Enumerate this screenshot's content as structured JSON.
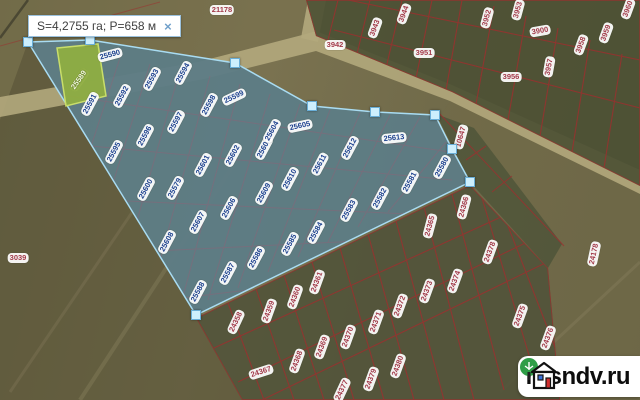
{
  "tooltip": {
    "area_perimeter": "S=4,2755 га; P=658 м",
    "close_label": "×"
  },
  "watermark": {
    "brand": "rosndv.ru"
  },
  "colors": {
    "selection_fill": "rgba(118,168,215,0.44)",
    "selection_stroke": "#a9dcf2",
    "handle_fill": "#cdeffd",
    "handle_border": "#69aed7",
    "parcel_line_red": "#9e2f2f",
    "label_text_blue": "#1d418f",
    "label_text_red": "#a33a4a",
    "highlight_parcel_green": "#93b23c",
    "road_tan": "#b3a87c",
    "field_olive": "#6e6847"
  },
  "selection": {
    "handles": [
      [
        28,
        42
      ],
      [
        90,
        40
      ],
      [
        235,
        63
      ],
      [
        312,
        106
      ],
      [
        375,
        112
      ],
      [
        435,
        115
      ],
      [
        452,
        149
      ],
      [
        470,
        182
      ],
      [
        196,
        315
      ]
    ]
  },
  "parcels": {
    "highlight": {
      "t": "25589",
      "x": 79,
      "y": 80,
      "r": -55
    },
    "selected": [
      {
        "t": "25590",
        "x": 110,
        "y": 55,
        "r": -15
      },
      {
        "t": "25591",
        "x": 90,
        "y": 104,
        "r": -62
      },
      {
        "t": "25592",
        "x": 122,
        "y": 96,
        "r": -62
      },
      {
        "t": "25593",
        "x": 152,
        "y": 79,
        "r": -62
      },
      {
        "t": "25594",
        "x": 183,
        "y": 73,
        "r": -62
      },
      {
        "t": "25595",
        "x": 114,
        "y": 152,
        "r": -62
      },
      {
        "t": "25596",
        "x": 145,
        "y": 136,
        "r": -62
      },
      {
        "t": "25597",
        "x": 176,
        "y": 122,
        "r": -62
      },
      {
        "t": "25598",
        "x": 209,
        "y": 105,
        "r": -62
      },
      {
        "t": "25599",
        "x": 234,
        "y": 97,
        "r": -25
      },
      {
        "t": "25600",
        "x": 146,
        "y": 189,
        "r": -62
      },
      {
        "t": "25601",
        "x": 203,
        "y": 165,
        "r": -62
      },
      {
        "t": "25602",
        "x": 233,
        "y": 155,
        "r": -62
      },
      {
        "t": "25603",
        "x": 264,
        "y": 148,
        "r": -62
      },
      {
        "t": "25604",
        "x": 272,
        "y": 131,
        "r": -62
      },
      {
        "t": "25605",
        "x": 300,
        "y": 126,
        "r": -12
      },
      {
        "t": "25606",
        "x": 229,
        "y": 208,
        "r": -62
      },
      {
        "t": "25607",
        "x": 198,
        "y": 222,
        "r": -62
      },
      {
        "t": "25608",
        "x": 167,
        "y": 242,
        "r": -62
      },
      {
        "t": "25609",
        "x": 264,
        "y": 193,
        "r": -62
      },
      {
        "t": "25610",
        "x": 290,
        "y": 179,
        "r": -62
      },
      {
        "t": "25611",
        "x": 320,
        "y": 164,
        "r": -62
      },
      {
        "t": "25612",
        "x": 350,
        "y": 148,
        "r": -62
      },
      {
        "t": "25613",
        "x": 394,
        "y": 138,
        "r": -6
      },
      {
        "t": "25579",
        "x": 175,
        "y": 188,
        "r": -62
      },
      {
        "t": "25580",
        "x": 442,
        "y": 167,
        "r": -62
      },
      {
        "t": "25581",
        "x": 410,
        "y": 182,
        "r": -62
      },
      {
        "t": "25582",
        "x": 380,
        "y": 198,
        "r": -62
      },
      {
        "t": "25583",
        "x": 349,
        "y": 210,
        "r": -62
      },
      {
        "t": "25584",
        "x": 316,
        "y": 232,
        "r": -62
      },
      {
        "t": "25585",
        "x": 290,
        "y": 244,
        "r": -62
      },
      {
        "t": "25586",
        "x": 256,
        "y": 258,
        "r": -62
      },
      {
        "t": "25587",
        "x": 228,
        "y": 273,
        "r": -62
      },
      {
        "t": "25588",
        "x": 198,
        "y": 292,
        "r": -62
      }
    ],
    "context": [
      {
        "t": "21178",
        "x": 222,
        "y": 10,
        "r": 0
      },
      {
        "t": "3942",
        "x": 335,
        "y": 45,
        "r": 0
      },
      {
        "t": "3943",
        "x": 375,
        "y": 28,
        "r": -70
      },
      {
        "t": "3944",
        "x": 404,
        "y": 14,
        "r": -70
      },
      {
        "t": "3951",
        "x": 424,
        "y": 53,
        "r": 0
      },
      {
        "t": "3952",
        "x": 487,
        "y": 18,
        "r": -75
      },
      {
        "t": "3953",
        "x": 518,
        "y": 10,
        "r": -75
      },
      {
        "t": "3900",
        "x": 540,
        "y": 31,
        "r": -10
      },
      {
        "t": "3956",
        "x": 511,
        "y": 77,
        "r": 0
      },
      {
        "t": "3957",
        "x": 549,
        "y": 67,
        "r": -80
      },
      {
        "t": "3958",
        "x": 581,
        "y": 45,
        "r": -70
      },
      {
        "t": "3959",
        "x": 606,
        "y": 33,
        "r": -70
      },
      {
        "t": "3960",
        "x": 628,
        "y": 9,
        "r": -70
      },
      {
        "t": "10647",
        "x": 461,
        "y": 137,
        "r": -75
      },
      {
        "t": "3039",
        "x": 18,
        "y": 258,
        "r": 0
      },
      {
        "t": "24366",
        "x": 464,
        "y": 207,
        "r": -75
      },
      {
        "t": "24365",
        "x": 430,
        "y": 226,
        "r": -75
      },
      {
        "t": "24378",
        "x": 490,
        "y": 252,
        "r": -70
      },
      {
        "t": "24374",
        "x": 455,
        "y": 281,
        "r": -70
      },
      {
        "t": "24373",
        "x": 427,
        "y": 291,
        "r": -70
      },
      {
        "t": "24361",
        "x": 317,
        "y": 282,
        "r": -70
      },
      {
        "t": "24360",
        "x": 295,
        "y": 297,
        "r": -70
      },
      {
        "t": "24359",
        "x": 269,
        "y": 311,
        "r": -70
      },
      {
        "t": "24358",
        "x": 236,
        "y": 322,
        "r": -65
      },
      {
        "t": "24372",
        "x": 400,
        "y": 306,
        "r": -70
      },
      {
        "t": "24371",
        "x": 376,
        "y": 322,
        "r": -70
      },
      {
        "t": "24370",
        "x": 348,
        "y": 337,
        "r": -70
      },
      {
        "t": "24369",
        "x": 322,
        "y": 347,
        "r": -70
      },
      {
        "t": "24368",
        "x": 297,
        "y": 361,
        "r": -70
      },
      {
        "t": "24367",
        "x": 261,
        "y": 372,
        "r": -18
      },
      {
        "t": "24380",
        "x": 398,
        "y": 366,
        "r": -70
      },
      {
        "t": "24379",
        "x": 371,
        "y": 379,
        "r": -70
      },
      {
        "t": "24377",
        "x": 342,
        "y": 390,
        "r": -65
      },
      {
        "t": "24375",
        "x": 520,
        "y": 316,
        "r": -70
      },
      {
        "t": "24376",
        "x": 548,
        "y": 338,
        "r": -70
      },
      {
        "t": "24178",
        "x": 594,
        "y": 254,
        "r": -78
      }
    ]
  }
}
